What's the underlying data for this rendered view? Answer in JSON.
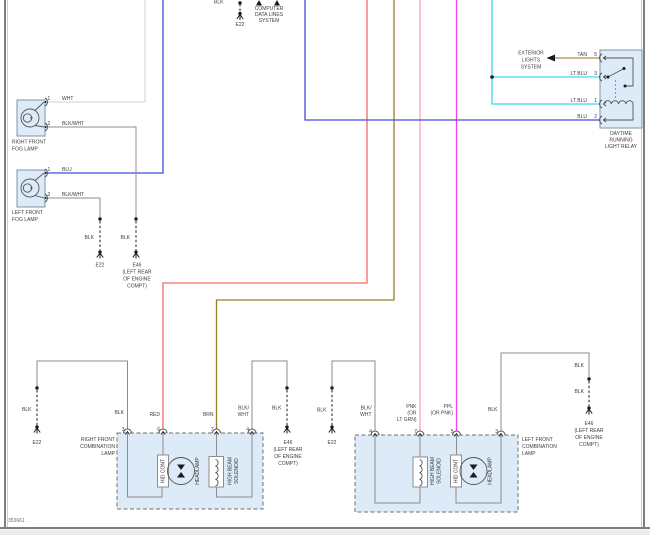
{
  "colors": {
    "wht": "#d9d9d9",
    "blk_wire": "#8c8c8c",
    "blu": "#4848e2",
    "lt_blu": "#35d9f4",
    "tan": "#a98e4d",
    "red": "#f76a64",
    "brn": "#9c7c2a",
    "pnk": "#ff9fd0",
    "ppl": "#fa3cf4",
    "component_fill": "#dcebf7",
    "ground": "#1a1a1a"
  },
  "page": {
    "diagram_number": "353661"
  },
  "top": {
    "cut_label": "BLK",
    "ground_id": "E22",
    "system": {
      "l1": "COMPUTER",
      "l2": "DATA LINES",
      "l3": "SYSTEM"
    }
  },
  "exterior": {
    "l1": "EXTERIOR",
    "l2": "LIGHTS",
    "l3": "SYSTEM"
  },
  "relay": {
    "name": {
      "l1": "DAYTIME",
      "l2": "RUNNING",
      "l3": "LIGHT RELAY"
    },
    "pin5_num": "5",
    "pin5_wire": "TAN",
    "pin3_num": "3",
    "pin3_wire": "LT BLU",
    "pin1_num": "1",
    "pin1_wire": "LT BLU",
    "pin2_num": "2",
    "pin2_wire": "BLU"
  },
  "fog_right": {
    "name": {
      "l1": "RIGHT FRONT",
      "l2": "FOG LAMP"
    },
    "pin1_num": "1",
    "pin1_wire": "WHT",
    "pin2_num": "2",
    "pin2_wire": "BLK/WHT"
  },
  "fog_left": {
    "name": {
      "l1": "LEFT FRONT",
      "l2": "FOG LAMP"
    },
    "pin1_num": "1",
    "pin1_wire": "BLU",
    "pin2_num": "2",
    "pin2_wire": "BLK/WHT"
  },
  "fog_grounds": {
    "g1_wire": "BLK",
    "g1_id": "E22",
    "g2_wire": "BLK",
    "g2_id": "E46",
    "g2_loc": {
      "l1": "(LEFT REAR",
      "l2": "OF ENGINE",
      "l3": "COMPT)"
    }
  },
  "combo_right": {
    "name": {
      "l1": "RIGHT FRONT",
      "l2": "COMBINATION",
      "l3": "LAMP"
    },
    "pin3_num": "3",
    "pin3_wire": "BLK",
    "pin6_num": "6",
    "pin6_wire": "RED",
    "pin7_num": "7",
    "pin7_wire": "BRN",
    "pin4_num": "4",
    "pin4_wire1": "BLK/",
    "pin4_wire2": "WHT",
    "hid": "HID CONT",
    "headlamp": "HEADLAMP",
    "sol1": "HIGH BEAM",
    "sol2": "SOLENOID",
    "gl_wire": "BLK",
    "gl_id": "E22",
    "gr_wire": "BLK",
    "gr_id": "E46",
    "gr_loc": {
      "l1": "(LEFT REAR",
      "l2": "OF ENGINE",
      "l3": "COMPT)"
    }
  },
  "combo_left": {
    "name": {
      "l1": "LEFT FRONT",
      "l2": "COMBINATION",
      "l3": "LAMP"
    },
    "pin4_num": "4",
    "pin4_wire1": "BLK/",
    "pin4_wire2": "WHT",
    "pin7_num": "7",
    "pin7_wire1": "PNK",
    "pin7_wire2": "(OR",
    "pin7_wire3": "LT GRN)",
    "pin5_num": "5",
    "pin5_wire1": "PPL",
    "pin5_wire2": "(OR PNK)",
    "pin3_num": "3",
    "pin3_wire": "BLK",
    "hid": "HID CONT",
    "headlamp": "HEADLAMP",
    "sol1": "HIGH BEAM",
    "sol2": "SOLENOID",
    "gl_wire": "BLK",
    "gl_id": "E22",
    "gr_wire_upper": "BLK",
    "gr_wire_lower": "BLK",
    "gr_id": "E46",
    "gr_loc": {
      "l1": "(LEFT REAR",
      "l2": "OF ENGINE",
      "l3": "COMPT)"
    }
  }
}
